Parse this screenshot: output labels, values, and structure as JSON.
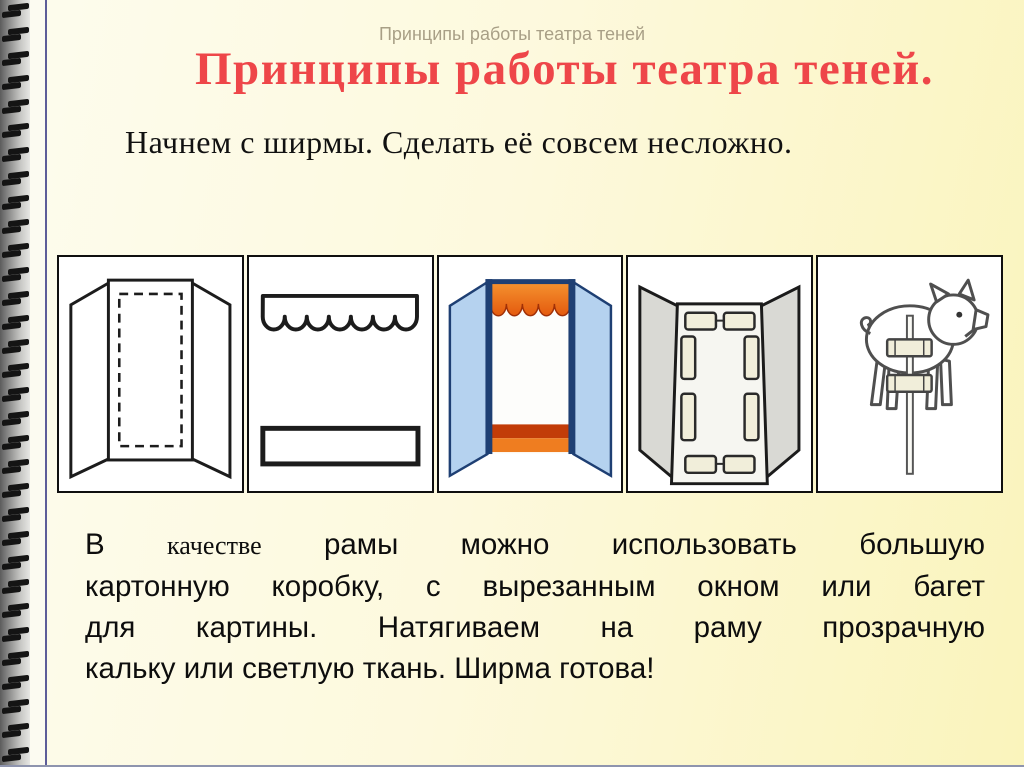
{
  "slide": {
    "ghost_title": "Принципы работы театра теней",
    "title": "Принципы работы театра теней.",
    "subtitle": "Начнем с ширмы. Сделать её совсем несложно.",
    "body": {
      "lead": "В",
      "serif_word": "качестве",
      "line1_rest": "рамы можно использовать большую",
      "line2": "картонную коробку, с вырезанным окном или багет",
      "line3": "для картины. Натягиваем на раму прозрачную",
      "line4": "кальку или светлую ткань. Ширма готова!"
    },
    "figures": [
      {
        "name": "folding-screen-cutout-figure"
      },
      {
        "name": "valance-and-plank-figure"
      },
      {
        "name": "assembled-screen-figure"
      },
      {
        "name": "screen-back-taped-figure"
      },
      {
        "name": "pig-puppet-on-stick-figure"
      }
    ]
  },
  "colors": {
    "page-bg-left": "#fdfcee",
    "page-bg-right": "#faf4bc",
    "title-red": "#ee4649",
    "ghost-gray": "#a89f86",
    "spine-line": "#5d5d99",
    "line-dark": "#1c1c1c",
    "navy": "#1e3f73",
    "wing-blue": "#b5d2ef",
    "curtain-orange": "#e45a0e",
    "curtain-light": "#f5932f",
    "curtain-dark": "#a03007",
    "base-dark": "#c23c08",
    "base-light": "#ef7d20",
    "wing-gray": "#d9d9d4",
    "tape-cream": "#f1eeda",
    "pig-gray": "#4f4f4f"
  }
}
